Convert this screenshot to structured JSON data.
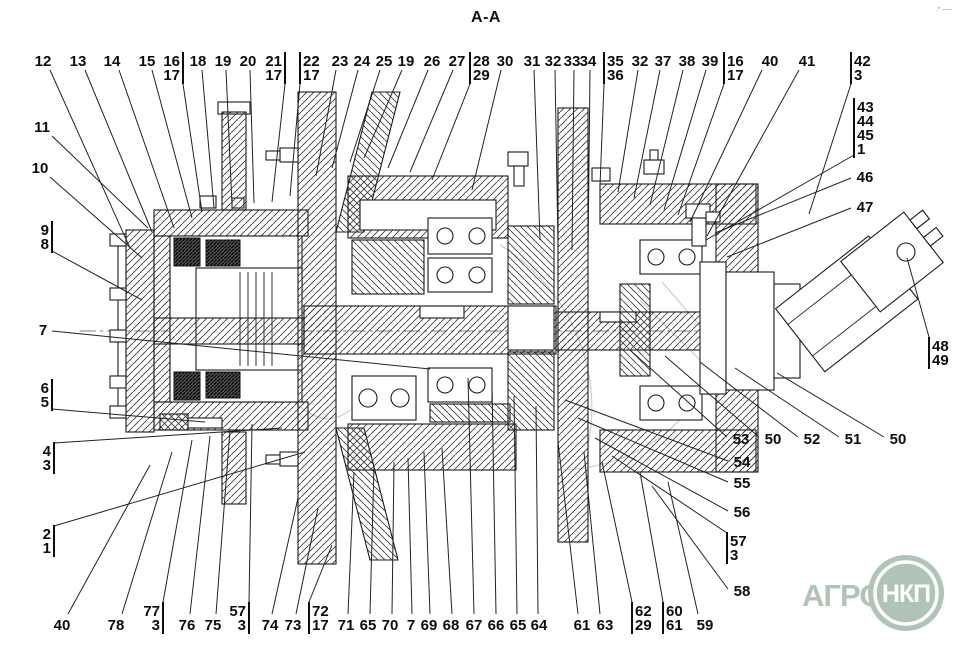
{
  "title": "A-A",
  "corner_mark": "·″ ──",
  "watermark": {
    "text": "АГРО",
    "badge": "НКП",
    "color": "#a9bfb1"
  },
  "callouts": [
    {
      "t": [
        "12"
      ],
      "x": 43,
      "y": 66,
      "f": [
        50,
        70
      ],
      "to": [
        130,
        248
      ]
    },
    {
      "t": [
        "13"
      ],
      "x": 78,
      "y": 66,
      "f": [
        85,
        70
      ],
      "to": [
        152,
        232
      ]
    },
    {
      "t": [
        "14"
      ],
      "x": 112,
      "y": 66,
      "f": [
        119,
        70
      ],
      "to": [
        174,
        228
      ]
    },
    {
      "t": [
        "15"
      ],
      "x": 147,
      "y": 66,
      "f": [
        152,
        70
      ],
      "to": [
        192,
        218
      ]
    },
    {
      "t": [
        "16",
        "17"
      ],
      "x": 170,
      "y": 66,
      "bar": 183,
      "f": [
        183,
        84
      ],
      "to": [
        202,
        212
      ]
    },
    {
      "t": [
        "18"
      ],
      "x": 198,
      "y": 66,
      "f": [
        202,
        70
      ],
      "to": [
        214,
        208
      ]
    },
    {
      "t": [
        "19"
      ],
      "x": 223,
      "y": 66,
      "f": [
        226,
        70
      ],
      "to": [
        232,
        205
      ]
    },
    {
      "t": [
        "20"
      ],
      "x": 248,
      "y": 66,
      "f": [
        250,
        70
      ],
      "to": [
        254,
        203
      ]
    },
    {
      "t": [
        "21",
        "17"
      ],
      "x": 271,
      "y": 66,
      "bar": 285,
      "f": [
        285,
        84
      ],
      "to": [
        272,
        202
      ]
    },
    {
      "t": [
        "22",
        "17"
      ],
      "x": 312,
      "y": 66,
      "bar": 300,
      "f": [
        300,
        84
      ],
      "to": [
        290,
        196
      ]
    },
    {
      "t": [
        "23"
      ],
      "x": 340,
      "y": 66,
      "f": [
        336,
        70
      ],
      "to": [
        316,
        176
      ]
    },
    {
      "t": [
        "24"
      ],
      "x": 362,
      "y": 66,
      "f": [
        358,
        70
      ],
      "to": [
        332,
        168
      ]
    },
    {
      "t": [
        "25"
      ],
      "x": 384,
      "y": 66,
      "f": [
        380,
        70
      ],
      "to": [
        350,
        162
      ]
    },
    {
      "t": [
        "19"
      ],
      "x": 406,
      "y": 66,
      "f": [
        402,
        70
      ],
      "to": [
        364,
        158
      ]
    },
    {
      "t": [
        "26"
      ],
      "x": 432,
      "y": 66,
      "f": [
        428,
        70
      ],
      "to": [
        388,
        168
      ]
    },
    {
      "t": [
        "27"
      ],
      "x": 457,
      "y": 66,
      "f": [
        453,
        70
      ],
      "to": [
        410,
        172
      ]
    },
    {
      "t": [
        "28",
        "29"
      ],
      "x": 483,
      "y": 66,
      "bar": 470,
      "f": [
        470,
        84
      ],
      "to": [
        432,
        180
      ]
    },
    {
      "t": [
        "30"
      ],
      "x": 505,
      "y": 66,
      "f": [
        501,
        70
      ],
      "to": [
        472,
        190
      ]
    },
    {
      "t": [
        "31"
      ],
      "x": 532,
      "y": 66,
      "f": [
        534,
        70
      ],
      "to": [
        540,
        240
      ]
    },
    {
      "t": [
        "32"
      ],
      "x": 553,
      "y": 66,
      "f": [
        555,
        70
      ],
      "to": [
        558,
        245
      ]
    },
    {
      "t": [
        "33"
      ],
      "x": 572,
      "y": 66,
      "f": [
        574,
        70
      ],
      "to": [
        572,
        250
      ]
    },
    {
      "t": [
        "34"
      ],
      "x": 588,
      "y": 66,
      "f": [
        590,
        70
      ],
      "to": [
        588,
        255
      ]
    },
    {
      "t": [
        "35",
        "36"
      ],
      "x": 617,
      "y": 66,
      "bar": 604,
      "f": [
        604,
        84
      ],
      "to": [
        600,
        186
      ]
    },
    {
      "t": [
        "32"
      ],
      "x": 640,
      "y": 66,
      "f": [
        638,
        70
      ],
      "to": [
        618,
        192
      ]
    },
    {
      "t": [
        "37"
      ],
      "x": 663,
      "y": 66,
      "f": [
        660,
        70
      ],
      "to": [
        634,
        198
      ]
    },
    {
      "t": [
        "38"
      ],
      "x": 687,
      "y": 66,
      "f": [
        683,
        70
      ],
      "to": [
        650,
        205
      ]
    },
    {
      "t": [
        "39"
      ],
      "x": 710,
      "y": 66,
      "f": [
        706,
        70
      ],
      "to": [
        664,
        210
      ]
    },
    {
      "t": [
        "16",
        "17"
      ],
      "x": 736,
      "y": 66,
      "bar": 724,
      "f": [
        724,
        84
      ],
      "to": [
        678,
        215
      ]
    },
    {
      "t": [
        "40"
      ],
      "x": 770,
      "y": 66,
      "f": [
        762,
        70
      ],
      "to": [
        690,
        222
      ]
    },
    {
      "t": [
        "41"
      ],
      "x": 807,
      "y": 66,
      "f": [
        799,
        70
      ],
      "to": [
        707,
        236
      ]
    },
    {
      "t": [
        "42",
        "3"
      ],
      "x": 863,
      "y": 66,
      "bar": 851,
      "f": [
        851,
        84
      ],
      "to": [
        809,
        214
      ]
    },
    {
      "t": [
        "43",
        "44",
        "45",
        "1"
      ],
      "x": 866,
      "y": 112,
      "bar": 854,
      "f": [
        854,
        155
      ],
      "to": [
        706,
        240
      ]
    },
    {
      "t": [
        "46"
      ],
      "x": 865,
      "y": 182,
      "f": [
        851,
        178
      ],
      "to": [
        715,
        233
      ]
    },
    {
      "t": [
        "47"
      ],
      "x": 865,
      "y": 212,
      "f": [
        851,
        208
      ],
      "to": [
        727,
        257
      ]
    },
    {
      "t": [
        "48",
        "49"
      ],
      "x": 941,
      "y": 351,
      "bar": 929,
      "f": [
        929,
        337
      ],
      "to": [
        907,
        258
      ]
    },
    {
      "t": [
        "11"
      ],
      "x": 42,
      "y": 132,
      "f": [
        52,
        136
      ],
      "to": [
        148,
        228
      ]
    },
    {
      "t": [
        "10"
      ],
      "x": 40,
      "y": 173,
      "f": [
        50,
        177
      ],
      "to": [
        142,
        258
      ]
    },
    {
      "t": [
        "9",
        "8"
      ],
      "x": 43,
      "y": 235,
      "bar": 52,
      "f": [
        52,
        251
      ],
      "to": [
        142,
        300
      ]
    },
    {
      "t": [
        "7"
      ],
      "x": 43,
      "y": 335,
      "f": [
        52,
        331
      ],
      "to": [
        430,
        369
      ]
    },
    {
      "t": [
        "6",
        "5"
      ],
      "x": 43,
      "y": 393,
      "bar": 52,
      "f": [
        52,
        409
      ],
      "to": [
        205,
        422
      ]
    },
    {
      "t": [
        "4",
        "3"
      ],
      "x": 45,
      "y": 456,
      "bar": 54,
      "f": [
        54,
        443
      ],
      "to": [
        282,
        428
      ]
    },
    {
      "t": [
        "2",
        "1"
      ],
      "x": 45,
      "y": 539,
      "bar": 54,
      "f": [
        54,
        526
      ],
      "to": [
        305,
        452
      ]
    },
    {
      "t": [
        "40"
      ],
      "x": 62,
      "y": 630,
      "f": [
        68,
        614
      ],
      "to": [
        150,
        465
      ]
    },
    {
      "t": [
        "78"
      ],
      "x": 116,
      "y": 630,
      "f": [
        122,
        614
      ],
      "to": [
        172,
        452
      ]
    },
    {
      "t": [
        "77",
        "3"
      ],
      "x": 150,
      "y": 616,
      "bar": 163,
      "f": [
        163,
        602
      ],
      "to": [
        192,
        440
      ]
    },
    {
      "t": [
        "76"
      ],
      "x": 187,
      "y": 630,
      "f": [
        190,
        614
      ],
      "to": [
        210,
        436
      ]
    },
    {
      "t": [
        "75"
      ],
      "x": 213,
      "y": 630,
      "f": [
        216,
        614
      ],
      "to": [
        230,
        430
      ]
    },
    {
      "t": [
        "57",
        "3"
      ],
      "x": 235,
      "y": 616,
      "bar": 249,
      "f": [
        249,
        602
      ],
      "to": [
        252,
        424
      ]
    },
    {
      "t": [
        "74"
      ],
      "x": 270,
      "y": 630,
      "f": [
        272,
        614
      ],
      "to": [
        298,
        498
      ]
    },
    {
      "t": [
        "73"
      ],
      "x": 293,
      "y": 630,
      "f": [
        296,
        614
      ],
      "to": [
        318,
        508
      ]
    },
    {
      "t": [
        "72",
        "17"
      ],
      "x": 321,
      "y": 616,
      "bar": 309,
      "f": [
        309,
        602
      ],
      "to": [
        332,
        545
      ]
    },
    {
      "t": [
        "71"
      ],
      "x": 346,
      "y": 630,
      "f": [
        348,
        614
      ],
      "to": [
        354,
        472
      ]
    },
    {
      "t": [
        "65"
      ],
      "x": 368,
      "y": 630,
      "f": [
        370,
        614
      ],
      "to": [
        374,
        466
      ]
    },
    {
      "t": [
        "70"
      ],
      "x": 390,
      "y": 630,
      "f": [
        392,
        614
      ],
      "to": [
        394,
        462
      ]
    },
    {
      "t": [
        "7"
      ],
      "x": 411,
      "y": 630,
      "f": [
        412,
        614
      ],
      "to": [
        408,
        458
      ]
    },
    {
      "t": [
        "69"
      ],
      "x": 429,
      "y": 630,
      "f": [
        430,
        614
      ],
      "to": [
        424,
        452
      ]
    },
    {
      "t": [
        "68"
      ],
      "x": 451,
      "y": 630,
      "f": [
        452,
        614
      ],
      "to": [
        442,
        448
      ]
    },
    {
      "t": [
        "67"
      ],
      "x": 474,
      "y": 630,
      "f": [
        474,
        614
      ],
      "to": [
        468,
        378
      ]
    },
    {
      "t": [
        "66"
      ],
      "x": 496,
      "y": 630,
      "f": [
        496,
        614
      ],
      "to": [
        492,
        386
      ]
    },
    {
      "t": [
        "65"
      ],
      "x": 518,
      "y": 630,
      "f": [
        517,
        614
      ],
      "to": [
        514,
        396
      ]
    },
    {
      "t": [
        "64"
      ],
      "x": 539,
      "y": 630,
      "f": [
        538,
        614
      ],
      "to": [
        536,
        406
      ]
    },
    {
      "t": [
        "61"
      ],
      "x": 582,
      "y": 630,
      "f": [
        578,
        614
      ],
      "to": [
        558,
        442
      ]
    },
    {
      "t": [
        "63"
      ],
      "x": 605,
      "y": 630,
      "f": [
        600,
        614
      ],
      "to": [
        584,
        452
      ]
    },
    {
      "t": [
        "62",
        "29"
      ],
      "x": 646,
      "y": 616,
      "bar": 632,
      "f": [
        632,
        602
      ],
      "to": [
        602,
        462
      ]
    },
    {
      "t": [
        "60",
        "61"
      ],
      "x": 677,
      "y": 616,
      "bar": 663,
      "f": [
        663,
        602
      ],
      "to": [
        640,
        472
      ]
    },
    {
      "t": [
        "59"
      ],
      "x": 705,
      "y": 630,
      "f": [
        698,
        614
      ],
      "to": [
        668,
        482
      ]
    },
    {
      "t": [
        "53"
      ],
      "x": 741,
      "y": 444,
      "f": [
        727,
        437
      ],
      "to": [
        630,
        350
      ]
    },
    {
      "t": [
        "50"
      ],
      "x": 773,
      "y": 444,
      "f": [
        759,
        437
      ],
      "to": [
        665,
        356
      ]
    },
    {
      "t": [
        "52"
      ],
      "x": 812,
      "y": 444,
      "f": [
        798,
        437
      ],
      "to": [
        700,
        362
      ]
    },
    {
      "t": [
        "51"
      ],
      "x": 853,
      "y": 444,
      "f": [
        839,
        437
      ],
      "to": [
        735,
        368
      ]
    },
    {
      "t": [
        "50"
      ],
      "x": 898,
      "y": 444,
      "f": [
        884,
        437
      ],
      "to": [
        777,
        373
      ]
    },
    {
      "t": [
        "54"
      ],
      "x": 742,
      "y": 467,
      "f": [
        728,
        461
      ],
      "to": [
        565,
        400
      ]
    },
    {
      "t": [
        "55"
      ],
      "x": 742,
      "y": 488,
      "f": [
        728,
        482
      ],
      "to": [
        578,
        418
      ]
    },
    {
      "t": [
        "56"
      ],
      "x": 742,
      "y": 517,
      "f": [
        728,
        511
      ],
      "to": [
        595,
        438
      ]
    },
    {
      "t": [
        "57",
        "3"
      ],
      "x": 740,
      "y": 546,
      "bar": 727,
      "f": [
        727,
        533
      ],
      "to": [
        612,
        456
      ]
    },
    {
      "t": [
        "58"
      ],
      "x": 742,
      "y": 596,
      "f": [
        728,
        589
      ],
      "to": [
        652,
        486
      ]
    }
  ]
}
